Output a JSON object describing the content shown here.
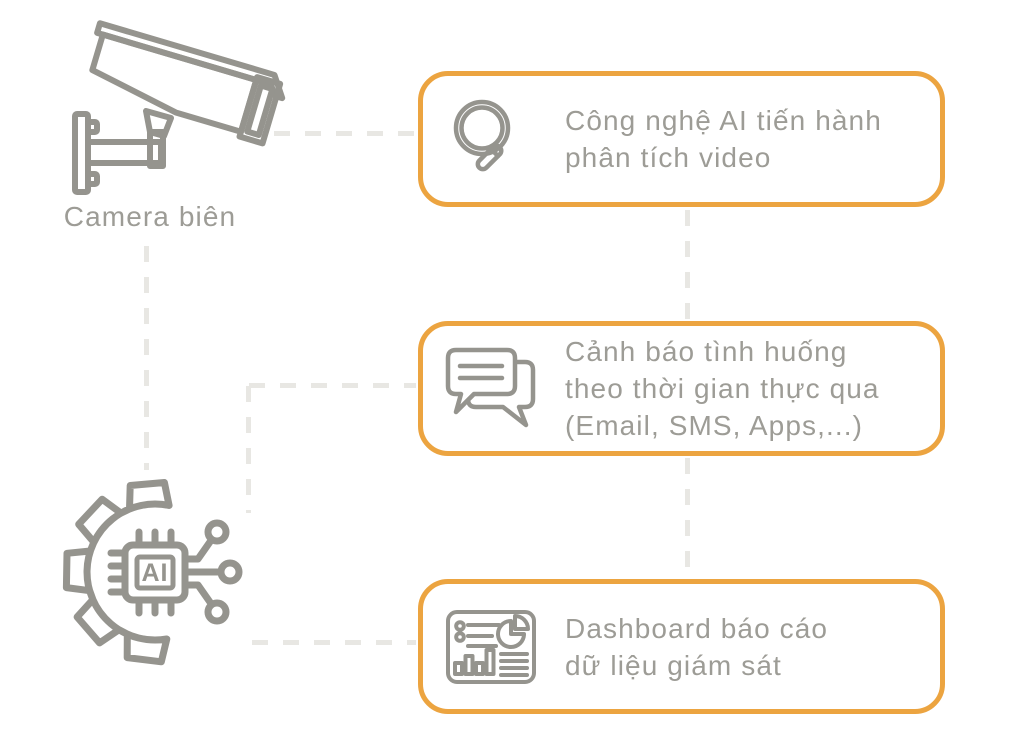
{
  "colors": {
    "accent_orange": "#ECA440",
    "line_art_gray": "#95948E",
    "text_gray": "#9D9C96",
    "connector_gray": "#E8E7E3"
  },
  "camera": {
    "label": "Camera biên",
    "icon": "cctv-camera-icon"
  },
  "ai_icon": {
    "label": "AI",
    "icon": "ai-chip-gear-icon"
  },
  "boxes": [
    {
      "icon": "search-icon",
      "lines": [
        "Công nghệ AI tiến hành",
        "phân tích video"
      ]
    },
    {
      "icon": "chat-icon",
      "lines": [
        "Cảnh báo tình huống",
        "theo thời gian thực qua",
        "(Email, SMS, Apps,...)"
      ]
    },
    {
      "icon": "dashboard-icon",
      "lines": [
        "Dashboard báo cáo",
        "dữ liệu giám sát"
      ]
    }
  ]
}
